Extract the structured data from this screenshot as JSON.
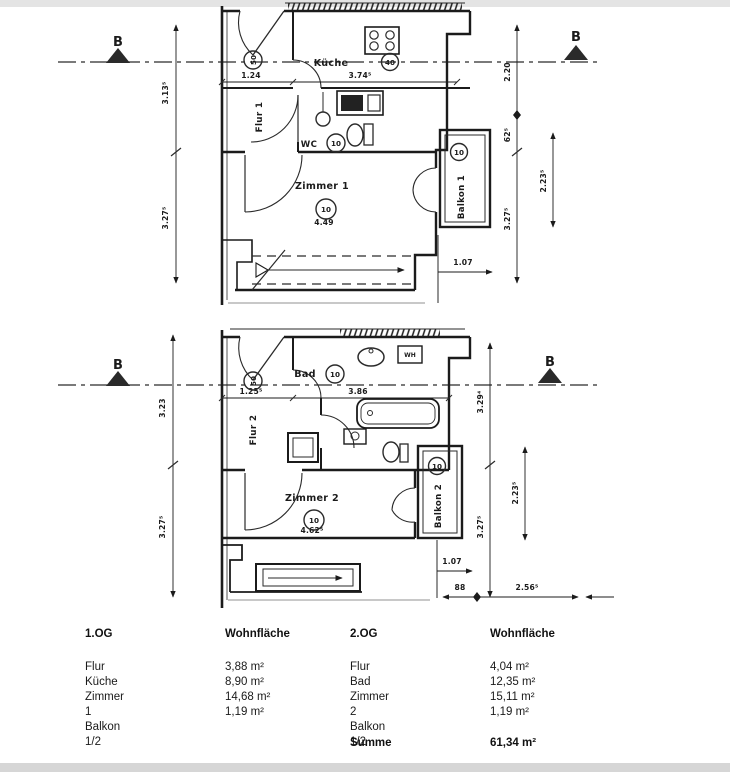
{
  "plan1": {
    "marker_left": "B",
    "marker_right": "B",
    "room_kueche": "Küche",
    "room_flur": "Flur 1",
    "room_wc": "WC",
    "room_zimmer": "Zimmer 1",
    "room_balkon": "Balkon 1",
    "circle_entry": "50",
    "circle_kueche": "40",
    "circle_wc": "10",
    "circle_zimmer": "10",
    "circle_balkon": "10",
    "dim_left_upper": "3.13⁵",
    "dim_left_lower": "3.27⁵",
    "dim_vestibule": "1.24",
    "dim_kueche": "3.74⁵",
    "dim_zimmer": "4.49",
    "dim_balkon_depth": "1.07",
    "dim_right_upper": "2.20",
    "dim_right_mid": "62⁵",
    "dim_right_lower": "3.27⁵",
    "dim_balkon_height": "2.23⁵"
  },
  "plan2": {
    "marker_left": "B",
    "marker_right": "B",
    "room_bad": "Bad",
    "room_flur": "Flur 2",
    "room_zimmer": "Zimmer 2",
    "room_balkon": "Balkon 2",
    "appliance_wh": "WH",
    "circle_entry": "50",
    "circle_bad": "10",
    "circle_zimmer": "10",
    "circle_balkon": "10",
    "dim_left_upper": "3.23",
    "dim_left_lower": "3.27⁵",
    "dim_vestibule": "1.25⁵",
    "dim_bad": "3.86",
    "dim_zimmer": "4.62⁵",
    "dim_balkon_depth": "1.07",
    "dim_right_upper": "3.29⁴",
    "dim_right_lower": "3.27⁵",
    "dim_balkon_height": "2.23⁵",
    "dim_bottom_small": "88",
    "dim_bottom_large": "2.56⁵"
  },
  "table": {
    "header_left_floor": "1.OG",
    "header_left_area": "Wohnfläche",
    "header_right_floor": "2.OG",
    "header_right_area": "Wohnfläche",
    "left_rows": [
      {
        "label": "Flur",
        "value": "3,88 m²"
      },
      {
        "label": "Küche",
        "value": "8,90 m²"
      },
      {
        "label": "Zimmer 1",
        "value": "14,68 m²"
      },
      {
        "label": "Balkon 1/2",
        "value": "1,19 m²"
      }
    ],
    "right_rows": [
      {
        "label": "Flur",
        "value": "4,04 m²"
      },
      {
        "label": "Bad",
        "value": "12,35 m²"
      },
      {
        "label": "Zimmer 2",
        "value": "15,11 m²"
      },
      {
        "label": "Balkon 1/2",
        "value": "1,19 m²"
      }
    ],
    "sum_label": "Summe",
    "sum_value": "61,34 m²"
  }
}
